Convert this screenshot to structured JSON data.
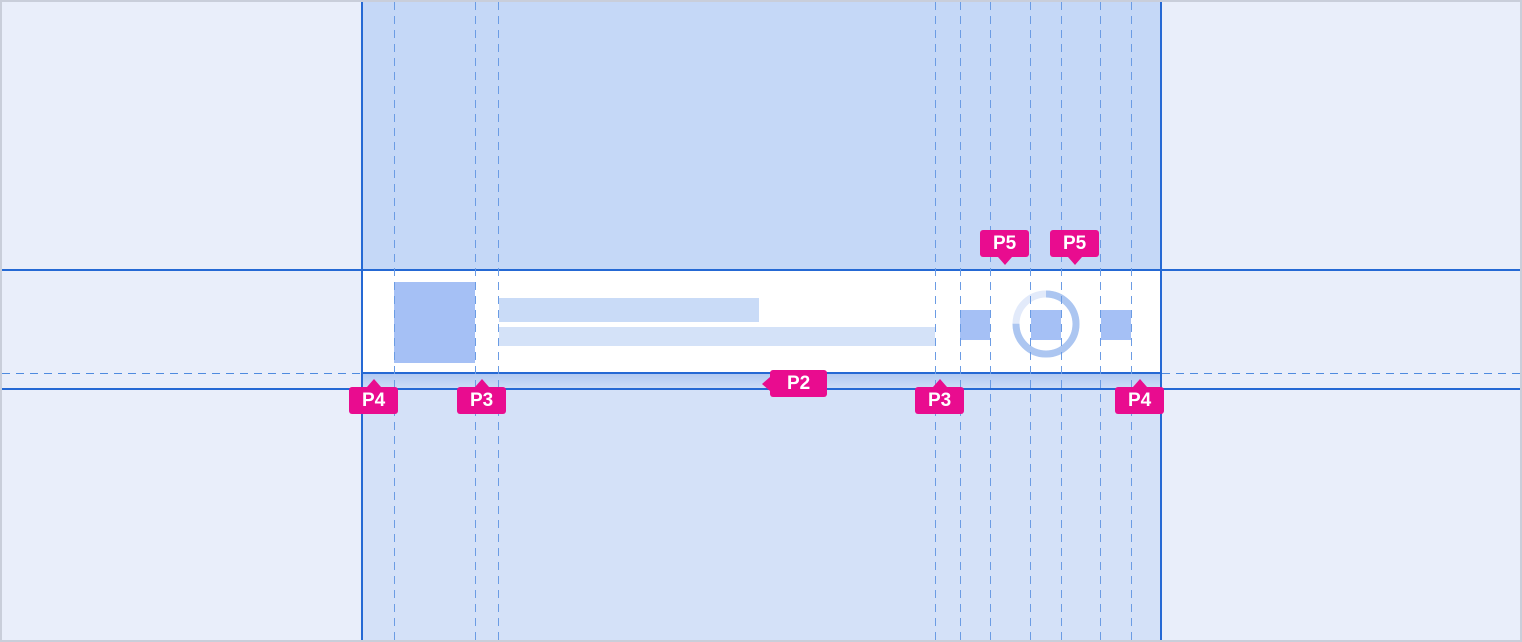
{
  "canvas": {
    "width": 1522,
    "height": 642,
    "description": "padding redline spec for list-item component"
  },
  "measurement_labels": {
    "p5_left": "P5",
    "p5_right": "P5",
    "p2": "P2",
    "p4_left": "P4",
    "p3_left": "P3",
    "p3_right": "P3",
    "p4_right": "P4"
  },
  "component": {
    "placeholders": {
      "avatar": "avatar-placeholder",
      "title": "title-line-placeholder",
      "subtitle": "subtitle-line-placeholder",
      "trailing_icons": [
        "icon-placeholder",
        "icon-placeholder",
        "icon-placeholder"
      ],
      "ring": "progress-ring"
    }
  },
  "colors": {
    "outer_background": "#E9EEFA",
    "column_above_row": "#C5D8F7",
    "column_below_row": "#D4E1F8",
    "row_background": "#FFFFFF",
    "band_gradient_top": "#B0C8F1",
    "band_gradient_bottom": "#CEDEF7",
    "solid_line": "#2569D4",
    "dashed_guide": "#6B9CE4",
    "placeholder_strong": "#A5C0F5",
    "placeholder_title": "#C9DBF7",
    "placeholder_subtitle": "#D4E2F8",
    "ring_track_light": "#E2EAFA",
    "ring_arc": "#ACC6F1",
    "badge_background": "#E90C8F",
    "badge_text": "#FFFFFF",
    "canvas_border": "#C9CEDA"
  }
}
